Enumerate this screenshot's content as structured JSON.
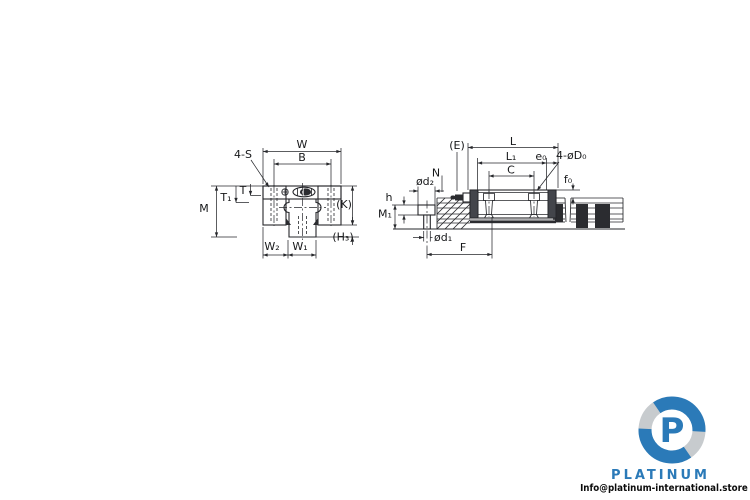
{
  "diagram": {
    "line_color": "#26272b",
    "front_view": {
      "labels": {
        "w": "W",
        "b": "B",
        "s": "4-S",
        "t1": "T₁",
        "t": "T",
        "m": "M",
        "k": "(K)",
        "h3": "(H₃)",
        "w2": "W₂",
        "w1": "W₁"
      }
    },
    "side_view": {
      "labels": {
        "e": "(E)",
        "l": "L",
        "l1": "L₁",
        "c": "C",
        "e0": "e₀",
        "d0": "4-øD₀",
        "f0": "f₀",
        "n": "N",
        "d2": "ød₂",
        "h": "h",
        "m1": "M₁",
        "d1": "ød₁",
        "f": "F"
      }
    }
  },
  "watermark": {
    "logo_letter": "P",
    "brand": "PLATINUM",
    "email": "Info@platinum-international.store",
    "brand_color": "#2b7ab8",
    "accent_gray": "#c7cbce"
  }
}
